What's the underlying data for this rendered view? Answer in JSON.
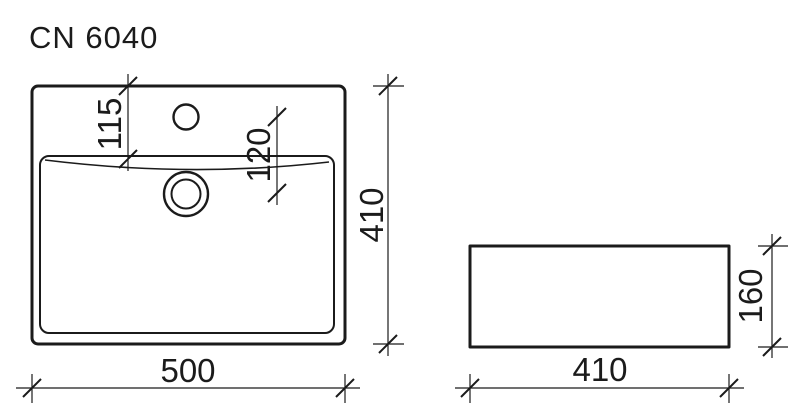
{
  "title": "CN 6040",
  "colors": {
    "line": "#1b1b1b",
    "background": "#ffffff"
  },
  "top_view": {
    "name": "top view",
    "width_dim": "500",
    "depth_dim": "410",
    "faucet_offset_dim": "115",
    "faucet_to_drain_dim": "120"
  },
  "side_view": {
    "name": "side view",
    "width_dim": "410",
    "height_dim": "160"
  }
}
